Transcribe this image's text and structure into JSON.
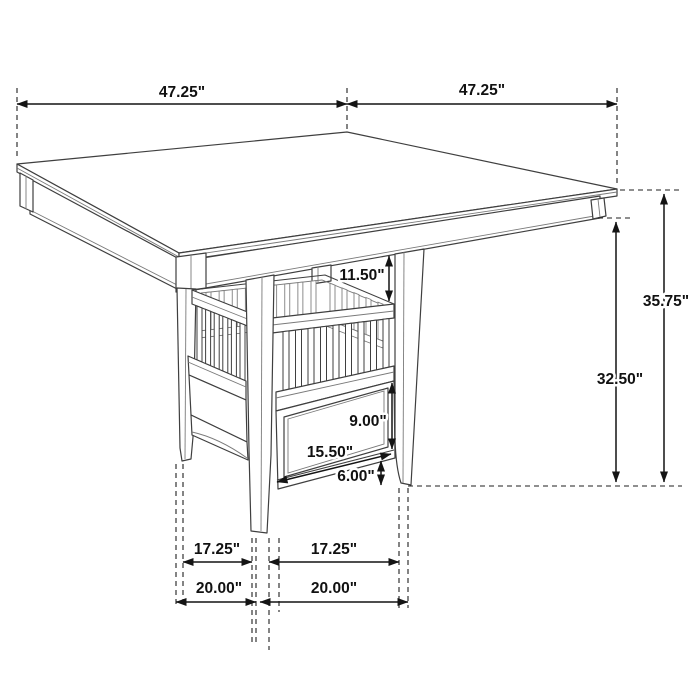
{
  "diagram": {
    "subject": "Counter-height square dining table with pedestal storage base, slatted shelf and drawer",
    "view": "three-quarter perspective line drawing with dimension callouts",
    "unit": "inches",
    "background_color": "#ffffff",
    "line_color": "#3f3f3f",
    "dimension_color": "#141414"
  },
  "labels": {
    "top_width_left": "47.25\"",
    "top_width_right": "47.25\"",
    "overall_height": "35.75\"",
    "height_to_apron": "32.50\"",
    "apron_to_shelf_top": "11.50\"",
    "drawer_front_height": "9.00\"",
    "drawer_width": "15.50\"",
    "base_ground_clearance": "6.00\"",
    "leg_span_inner_left": "17.25\"",
    "leg_span_inner_right": "17.25\"",
    "leg_span_outer_left": "20.00\"",
    "leg_span_outer_right": "20.00\""
  },
  "dimensions": [
    {
      "value": 47.25,
      "unit": "in",
      "measures": "tabletop edge, back-left half"
    },
    {
      "value": 47.25,
      "unit": "in",
      "measures": "tabletop edge, back-right half"
    },
    {
      "value": 35.75,
      "unit": "in",
      "measures": "floor to tabletop surface"
    },
    {
      "value": 32.5,
      "unit": "in",
      "measures": "floor to bottom of apron"
    },
    {
      "value": 11.5,
      "unit": "in",
      "measures": "apron bottom to shelf top rail"
    },
    {
      "value": 9.0,
      "unit": "in",
      "measures": "drawer front height"
    },
    {
      "value": 15.5,
      "unit": "in",
      "measures": "drawer width along base"
    },
    {
      "value": 6.0,
      "unit": "in",
      "measures": "base bottom rail to floor"
    },
    {
      "value": 17.25,
      "unit": "in",
      "measures": "clear span between left and front legs"
    },
    {
      "value": 17.25,
      "unit": "in",
      "measures": "clear span between front and right legs"
    },
    {
      "value": 20.0,
      "unit": "in",
      "measures": "outer span left pair of legs"
    },
    {
      "value": 20.0,
      "unit": "in",
      "measures": "outer span right pair of legs"
    }
  ]
}
